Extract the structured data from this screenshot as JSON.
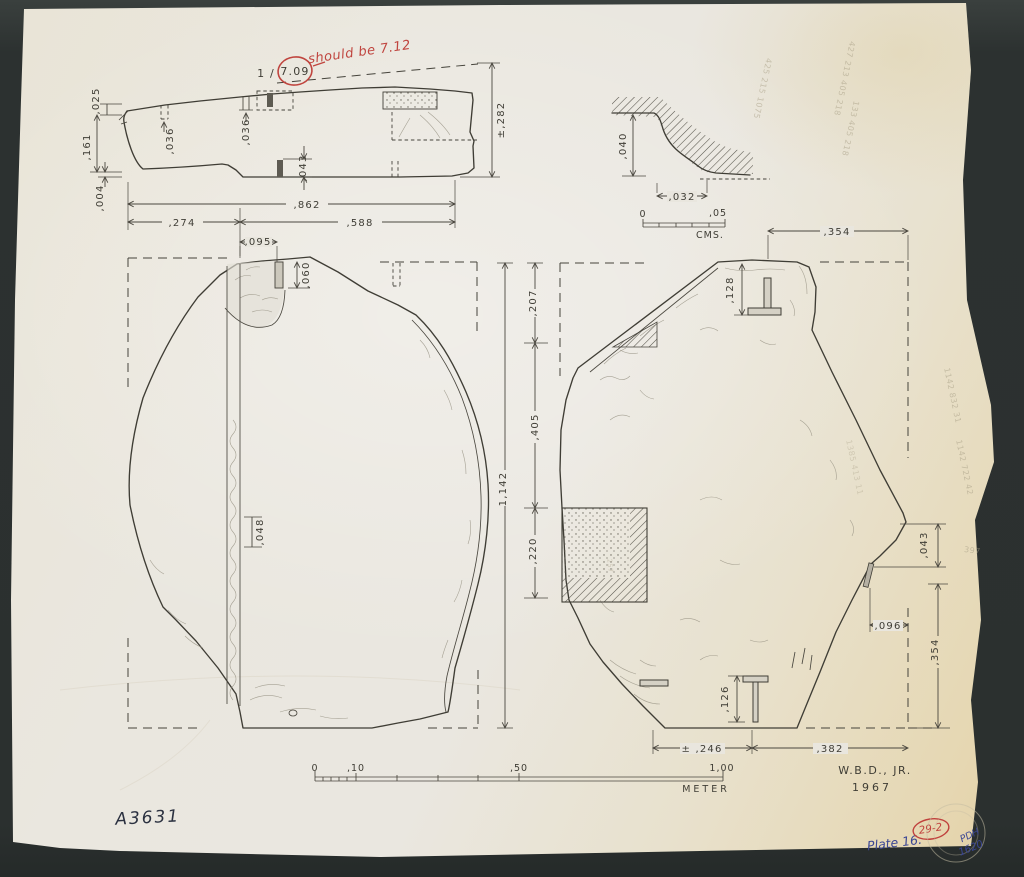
{
  "section_view": {
    "d025": ",025",
    "d161": ",161",
    "d004": ",004",
    "d036_a": ",036",
    "d036_b": ",036",
    "d043": ",043",
    "d274": ",274",
    "d588": ",588",
    "d862": ",862",
    "d282": "±,282"
  },
  "red_note": {
    "prefix": "1 /",
    "circled": "7.09",
    "correction": "should be 7.12"
  },
  "detail_view": {
    "d040": ",040",
    "d032": ",032",
    "scale_start": "0",
    "scale_end": ",05",
    "scale_unit": "CMS."
  },
  "left_plan": {
    "d095": ",095",
    "d060": ",060",
    "d048": ",048"
  },
  "between": {
    "d207": ",207",
    "d405": ",405",
    "d220": ",220",
    "d1142": "1,142"
  },
  "right_plan": {
    "d354_top": ",354",
    "d128": ",128",
    "d043": ",043",
    "d096": ",096",
    "d354_right": ",354",
    "d126": ",126",
    "d246": "± ,246",
    "d382": ",382"
  },
  "scale_bar": {
    "t0": "0",
    "t10": ",10",
    "t50": ",50",
    "t100": "1,00",
    "unit": "METER"
  },
  "signature": {
    "author": "W.B.D., JR.",
    "year": "1967"
  },
  "marks": {
    "catalog": "A3631",
    "plate": "Plate 16.",
    "index": "29-2",
    "stamp_1": "PDH",
    "stamp_2": "1620"
  },
  "pencil": {
    "notes": [
      "425 215 1075",
      "427 213 405 218",
      "133 405 218",
      "1142 832 31",
      "1142 722 42",
      "1385 413 11",
      "397",
      "257"
    ]
  }
}
